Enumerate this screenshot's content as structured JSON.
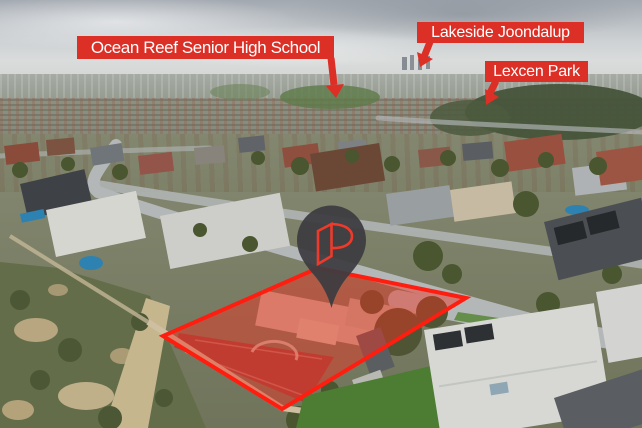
{
  "palette": {
    "sky_top": "#a2a8b0",
    "sky_horizon": "#dadcdc",
    "haze": "#99a095",
    "suburb_ground": "#83876f",
    "bushland": "#646d4a",
    "sand": "#c6b68e",
    "road": "#b3b7b8",
    "lawn": "#4d7c33",
    "label_background": "#dc2f26",
    "label_text": "#ffffff",
    "annotation_red": "#dc2f26",
    "boundary_stroke": "#ff1d10",
    "boundary_fill": "rgba(243,48,34,0.45)",
    "pin_body": "#3c3c41",
    "pin_logo": "#ef3a2b"
  },
  "labels": [
    {
      "text": "Ocean Reef Senior High School",
      "arrow_shaft": "M331 58 L334 85",
      "arrow_head": "344,84 326,86 336,98"
    },
    {
      "text": "Lakeside Joondalup",
      "arrow_shaft": "M430 42 L424 57",
      "arrow_head": "433,59 417,52 420,67"
    },
    {
      "text": "Lexcen Park",
      "arrow_shaft": "M496 81 L489 95",
      "arrow_head": "499,97 485,89 486,105"
    }
  ],
  "highlight": {
    "points": "318,268 466,298 282,409 163,336"
  },
  "pin": {
    "letter": "P"
  }
}
